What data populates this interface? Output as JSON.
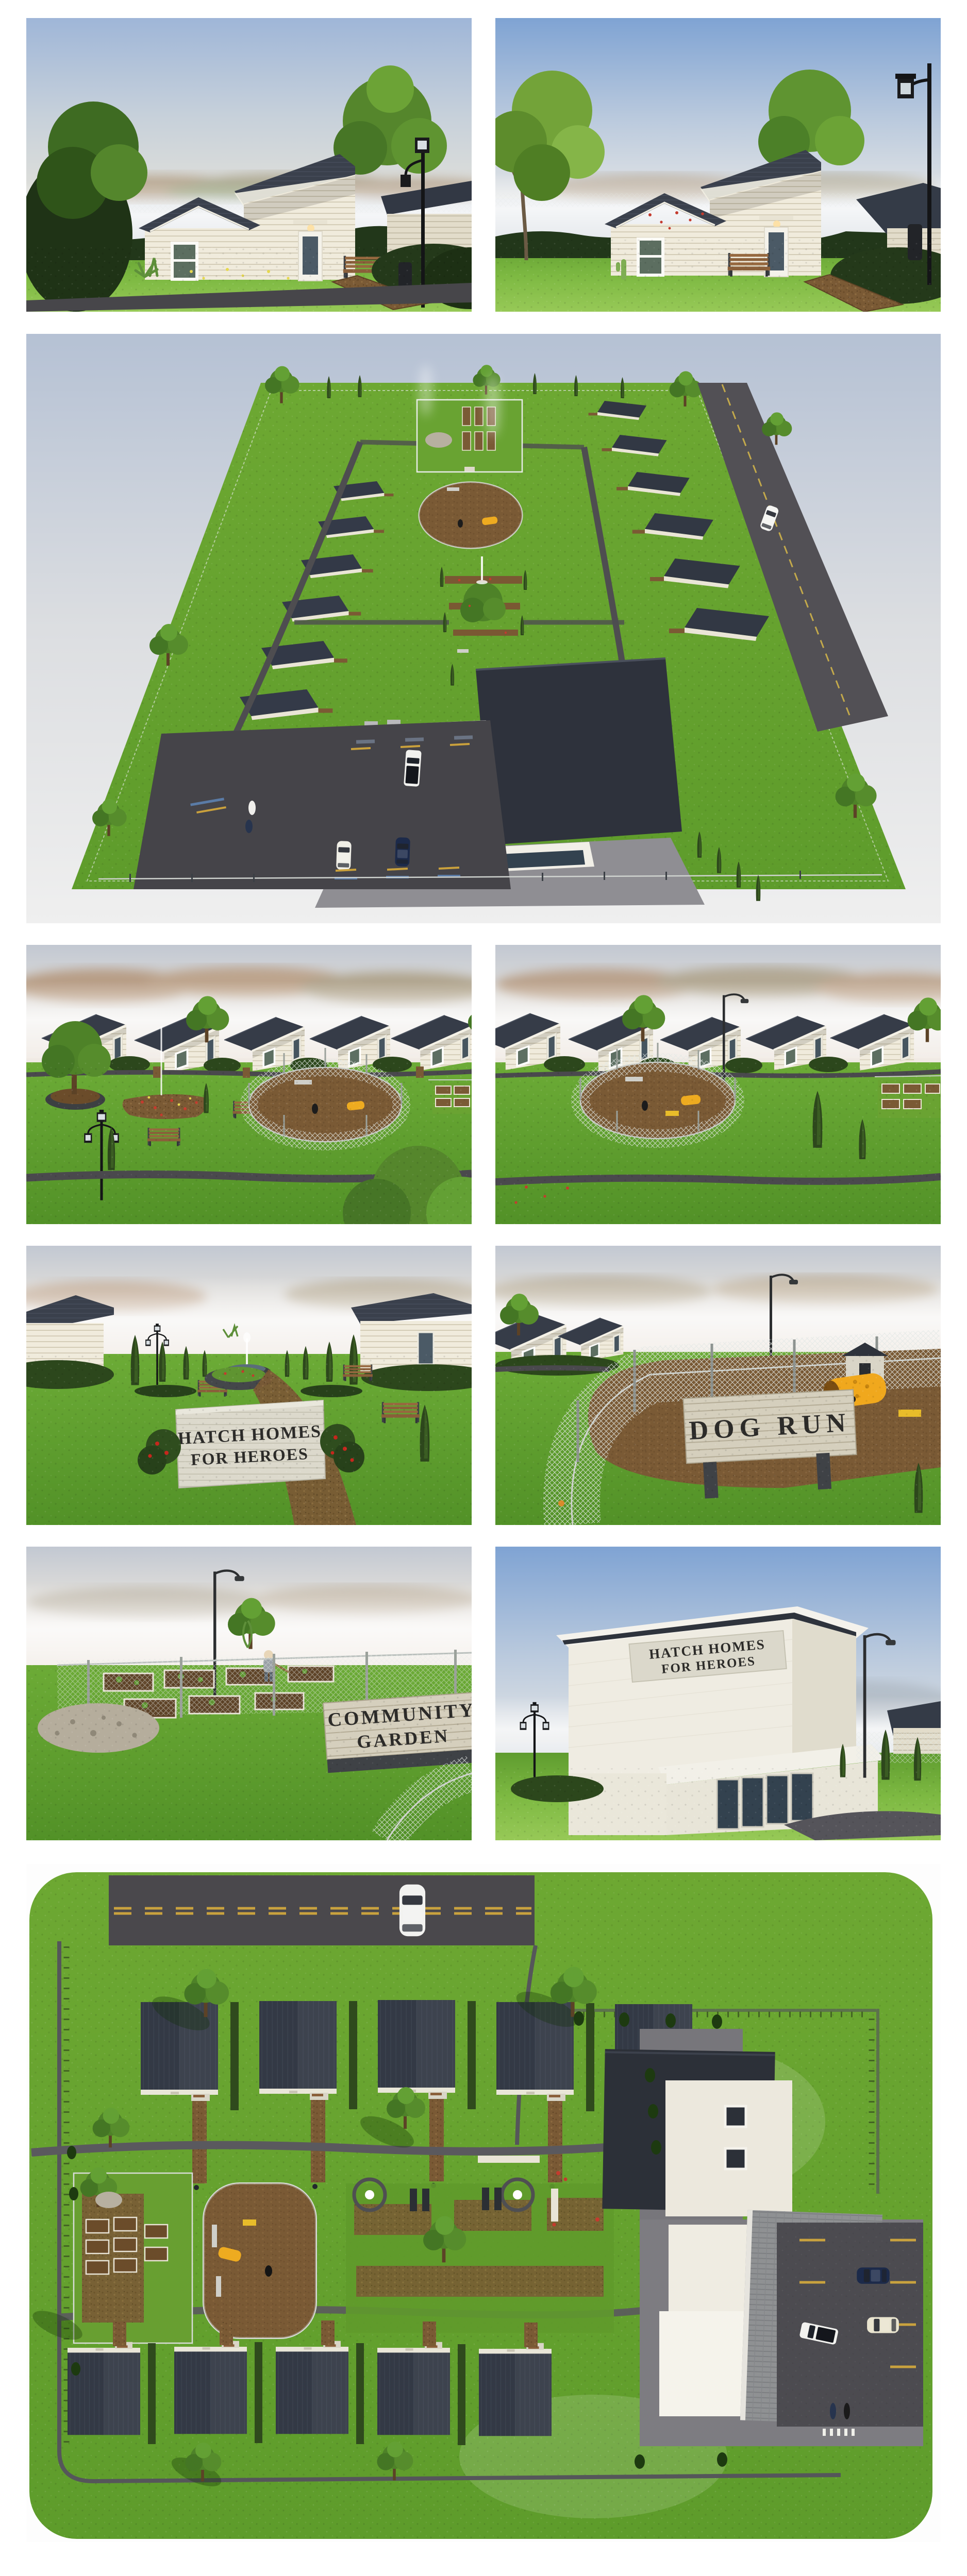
{
  "page": {
    "title": "Hatch Homes for Heroes — architectural rendering board",
    "background": "#ffffff"
  },
  "signs": {
    "monument": {
      "line1": "HATCH HOMES",
      "line2": "FOR HEROES"
    },
    "dog_run": "DOG RUN",
    "community_garden": {
      "line1": "COMMUNITY",
      "line2": "GARDEN"
    },
    "building": {
      "line1": "HATCH HOMES",
      "line2": "FOR HEROES"
    }
  },
  "colors": {
    "page_background": "#ffffff",
    "sky_blue": "#87a9d6",
    "sky_haze": "#dedcd8",
    "grass": "#6fae38",
    "grass_bright": "#8ac24e",
    "roof_dark": "#363c48",
    "siding_cream": "#f0ebdc",
    "asphalt": "#4a494d",
    "mulch": "#7a5a35",
    "sign_stone": "#d9d6c9",
    "sign_wood": "#cfc9b6",
    "accent_yellow": "#f0b428",
    "flower_red": "#c43b2e"
  },
  "gallery": [
    {
      "id": "render-tiny-home-front-a",
      "description": "Tiny home exterior, mono-pitch roof, lawn and mulch path, view A"
    },
    {
      "id": "render-tiny-home-front-b",
      "description": "Tiny home exterior with street lamp and red poppies, view B"
    },
    {
      "id": "render-site-aerial",
      "description": "Three-quarter aerial of full community: two house rows, community garden, dog run, promenade, community building, parking"
    },
    {
      "id": "render-park-flower-garden",
      "description": "Central park with flower beds, benches, lamp posts and dog run before row of five tiny homes"
    },
    {
      "id": "render-park-dog-run",
      "description": "Central park view centered on fenced dog run before row of five tiny homes"
    },
    {
      "id": "render-memorial-garden",
      "description": "Formal fountain garden with cypress alley and Hatch Homes for Heroes monument sign"
    },
    {
      "id": "render-dog-run-closeup",
      "description": "Chain-link dog run with DOG RUN sign, yellow play tunnel, dog house and dog"
    },
    {
      "id": "render-community-garden",
      "description": "Fenced community garden with raised beds, gardener and COMMUNITY GARDEN sign"
    },
    {
      "id": "render-community-building",
      "description": "Community building with HATCH HOMES FOR HEROES facade sign and glass entrance"
    },
    {
      "id": "render-site-plan",
      "description": "Top-down site plan: street with car, ten tiny homes, garden beds, dog run, formal garden, community building and parking lot"
    }
  ]
}
